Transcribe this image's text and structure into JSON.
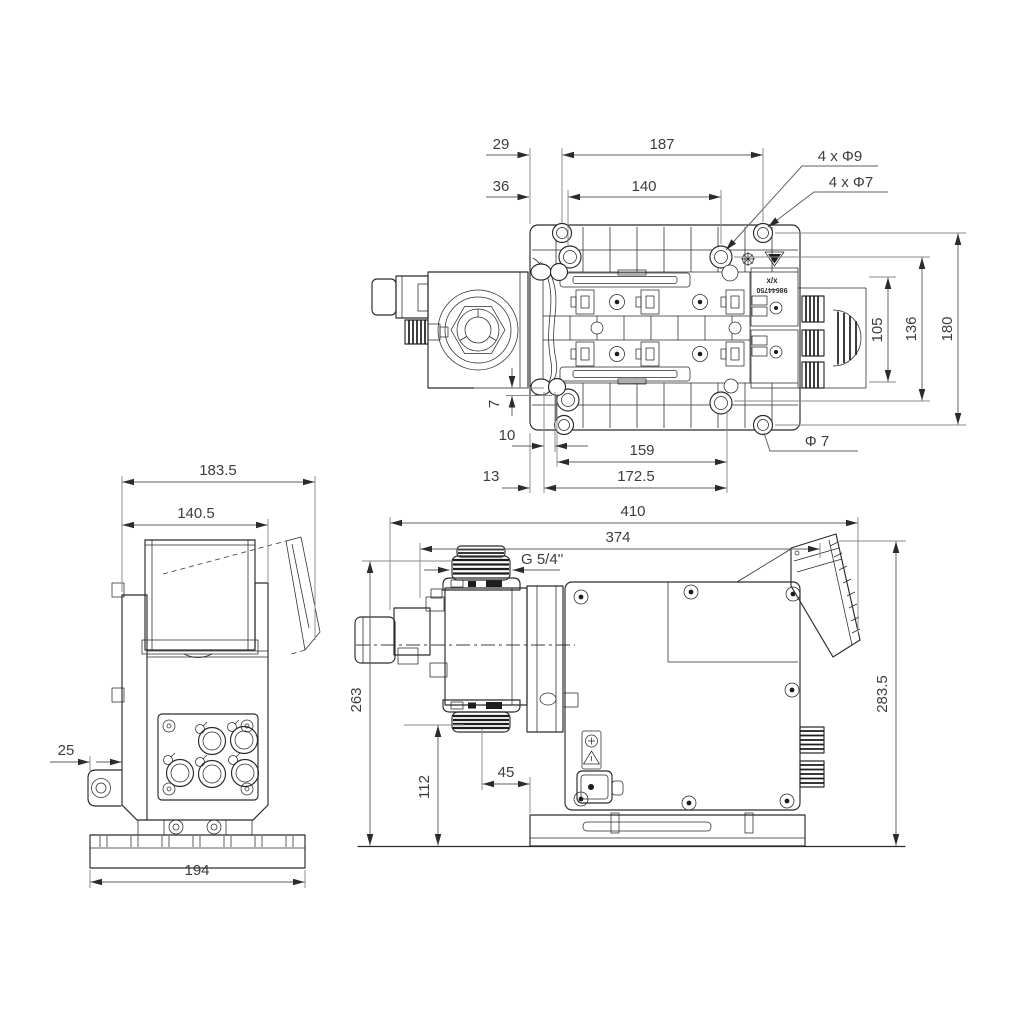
{
  "drawing": {
    "top_view": {
      "dims": {
        "d29": "29",
        "d187": "187",
        "d36": "36",
        "d140": "140",
        "holes_outer": "4 x Φ9",
        "holes_inner": "4 x Φ7",
        "d105": "105",
        "d136": "136",
        "d180": "180",
        "d7": "7",
        "d10": "10",
        "d159": "159",
        "dphi7": "Φ 7",
        "d13": "13",
        "d172": "172.5"
      },
      "markings": {
        "ratio": "x/x",
        "part_no": "98644750"
      }
    },
    "front_view": {
      "dims": {
        "d183": "183.5",
        "d140": "140.5",
        "d25": "25",
        "d194": "194"
      }
    },
    "side_view": {
      "dims": {
        "d410": "410",
        "d374": "374",
        "thread": "G 5/4''",
        "d263": "263",
        "d112": "112",
        "d45": "45",
        "d283": "283.5"
      }
    }
  }
}
